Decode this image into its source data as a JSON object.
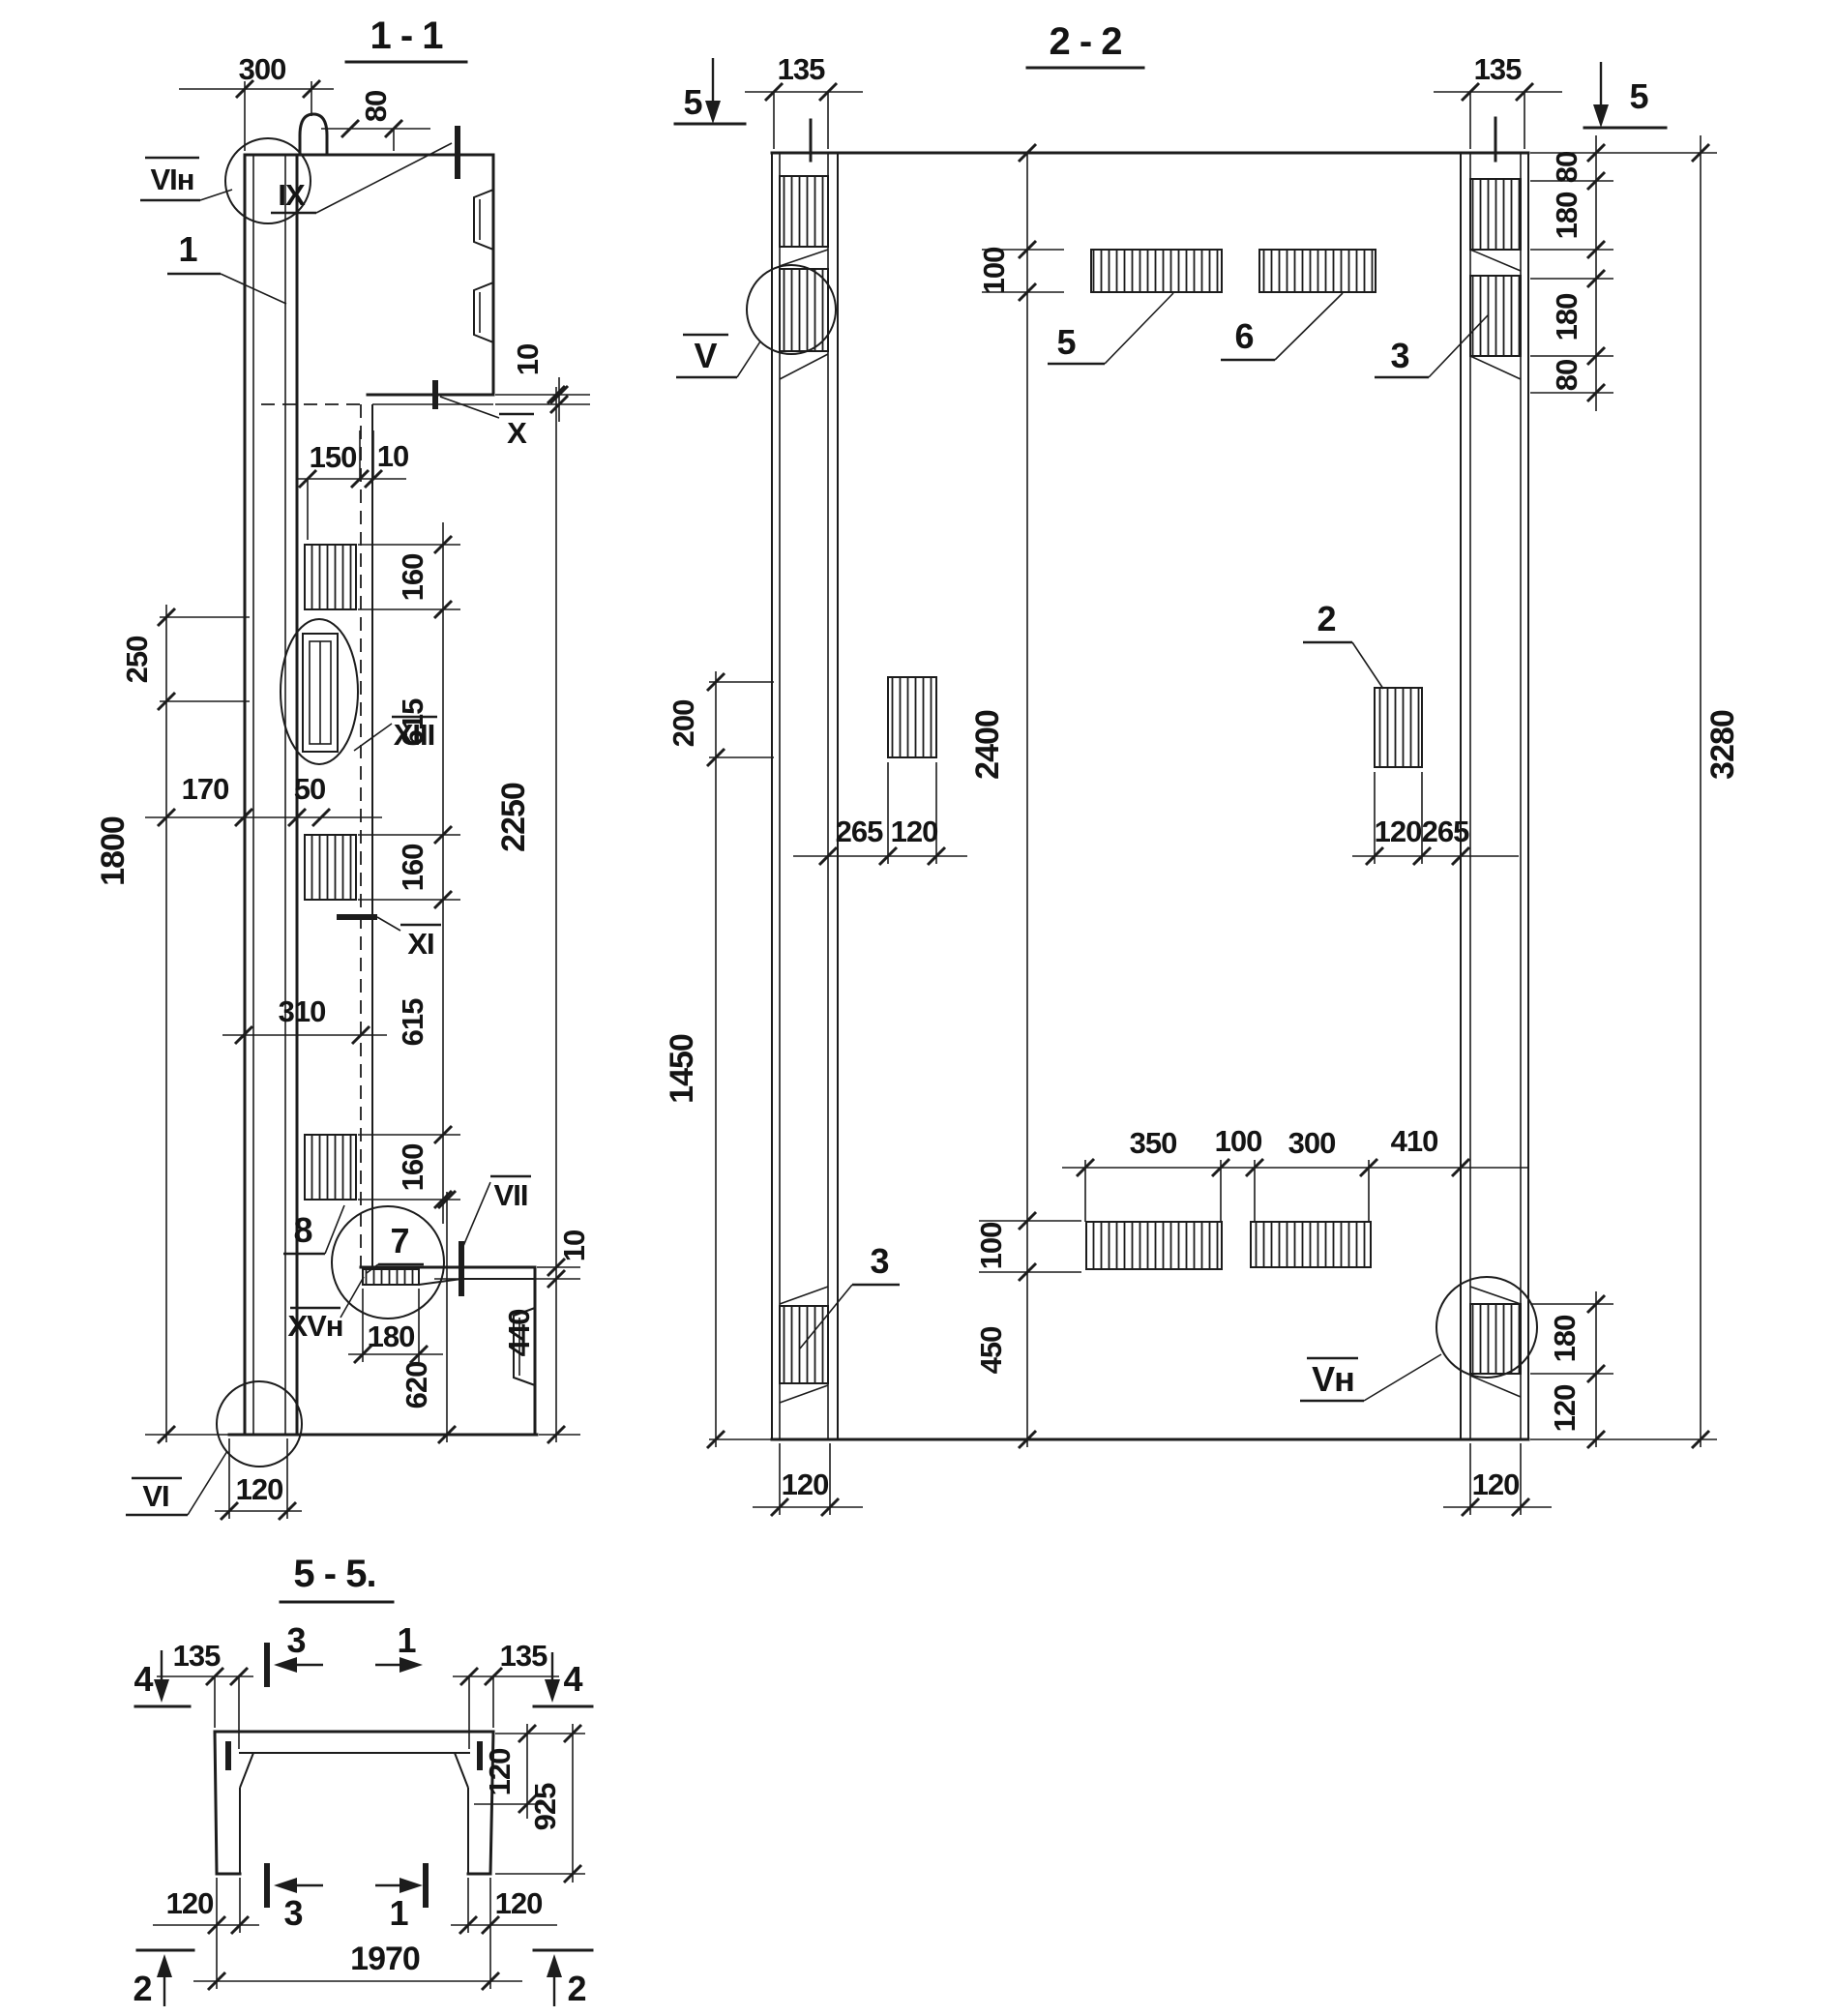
{
  "s11": {
    "title": "1 - 1",
    "callout_1": "1",
    "callout_7": "7",
    "callout_8": "8",
    "label_vi_n": "VIн",
    "label_ix": "IX",
    "label_x": "X",
    "label_xiii": "XIII",
    "label_xi": "XI",
    "label_vii": "VII",
    "label_xv_n": "XVн",
    "label_vi": "VI",
    "dim_300": "300",
    "dim_80": "80",
    "dim_10_top": "10",
    "dim_150": "150",
    "dim_10_mid": "10",
    "dim_160_a": "160",
    "dim_615_a": "615",
    "dim_160_b": "160",
    "dim_615_b": "615",
    "dim_160_c": "160",
    "dim_2250": "2250",
    "dim_250": "250",
    "dim_170": "170",
    "dim_50": "50",
    "dim_310": "310",
    "dim_1800": "1800",
    "dim_10_bot": "10",
    "dim_440": "440",
    "dim_620": "620",
    "dim_180": "180",
    "dim_120": "120"
  },
  "s22": {
    "title": "2 - 2",
    "marker_5_left": "5",
    "marker_5_right": "5",
    "dim_135_left": "135",
    "dim_135_right": "135",
    "dim_80_a": "80",
    "dim_180_a": "180",
    "dim_180_b": "180",
    "dim_80_b": "80",
    "dim_3280": "3280",
    "dim_100_top": "100",
    "callout_5": "5",
    "callout_6": "6",
    "callout_3_right": "3",
    "label_v": "V",
    "dim_200": "200",
    "callout_2": "2",
    "dim_2400": "2400",
    "dim_265_left": "265",
    "dim_120_left": "120",
    "dim_120_right": "120",
    "dim_265_right": "265",
    "dim_1450": "1450",
    "dim_350": "350",
    "dim_100_mid": "100",
    "dim_300": "300",
    "dim_410": "410",
    "dim_100_low": "100",
    "dim_450": "450",
    "callout_3_left": "3",
    "label_v_n": "Vн",
    "dim_180_low": "180",
    "dim_120_low": "120",
    "dim_120_bot_left": "120",
    "dim_120_bot_right": "120"
  },
  "s55": {
    "title": "5 - 5.",
    "marker_4_left": "4",
    "marker_4_right": "4",
    "marker_3_top": "3",
    "marker_1_top": "1",
    "marker_3_bot": "3",
    "marker_1_bot": "1",
    "marker_2_left": "2",
    "marker_2_right": "2",
    "dim_135_left": "135",
    "dim_135_right": "135",
    "dim_120_slab": "120",
    "dim_925": "925",
    "dim_120_bot_left": "120",
    "dim_120_bot_right": "120",
    "dim_1970": "1970"
  }
}
